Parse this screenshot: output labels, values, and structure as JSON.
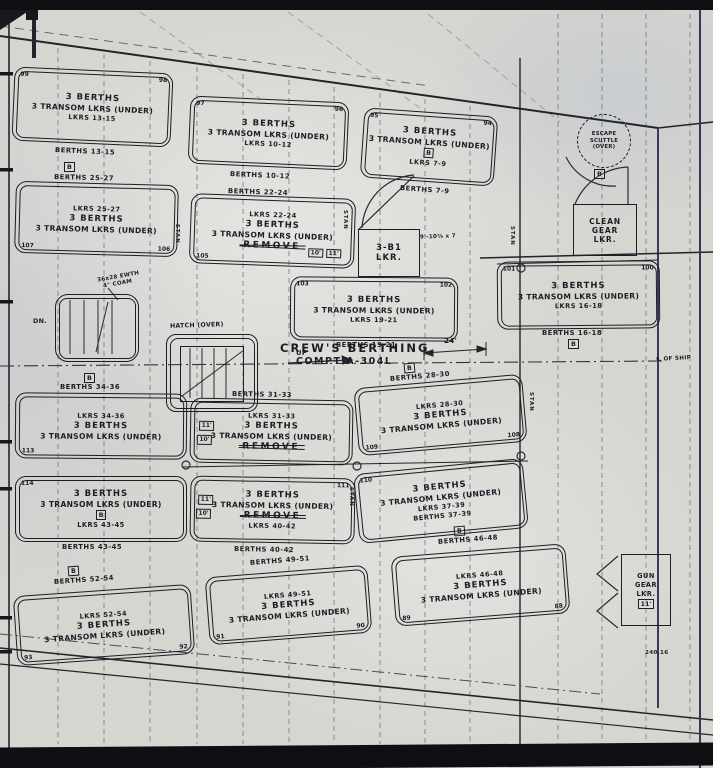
{
  "common": {
    "l1": "3 BERTHS",
    "l2": "3 TRANSOM LKRS (UNDER)",
    "remove": "REMOVE",
    "b": "B"
  },
  "title": {
    "line1": "CREW'S BERTHING",
    "line2": "COMPT A-304L"
  },
  "notes": {
    "up": "UP",
    "dn": "DN.",
    "hatch": "HATCH (OVER)",
    "ewth1": "36x28 EWTH",
    "ewth2": "4\" COAM",
    "dim24": "24'",
    "dim_note": "9'-10⅜ x 7",
    "centerline": "℄ OF SHIP",
    "frame": "240.16",
    "stan": "STAN"
  },
  "lockers": {
    "escape": {
      "l1": "ESCAPE",
      "l2": "SCUTTLE",
      "l3": "(OVER)"
    },
    "clean": {
      "l1": "CLEAN",
      "l2": "GEAR",
      "l3": "LKR."
    },
    "b1": {
      "l1": "3-B1",
      "l2": "LKR."
    },
    "gun": {
      "l1": "GUN",
      "l2": "GEAR",
      "l3": "LKR.",
      "size": "11'"
    }
  },
  "blocks": {
    "r1a": {
      "lkrs": "LKRS 13-15",
      "berths": "BERTHS 13-15",
      "n1": "99",
      "n2": "98"
    },
    "r1b": {
      "lkrs": "LKRS 10-12",
      "berths": "BERTHS 10-12",
      "n1": "97",
      "n2": "96"
    },
    "r1c": {
      "lkrs": "LKRS 7-9",
      "berths": "BERTHS 7-9",
      "n1": "95",
      "n2": "94"
    },
    "r2a": {
      "lkrs": "LKRS 25-27",
      "berths": "BERTHS 25-27",
      "n1": "107",
      "n2": "106"
    },
    "r2b": {
      "lkrs": "LKRS 22-24",
      "berths": "BERTHS 22-24",
      "n1": "105",
      "s1": "10'",
      "s2": "11'"
    },
    "r2c": {
      "lkrs": "LKRS 19-21",
      "berths": "BERTHS 19-21",
      "n1": "103",
      "n2": "102"
    },
    "r2d": {
      "lkrs": "LKRS 16-18",
      "berths": "BERTHS 16-18",
      "n1": "101",
      "n2": "100"
    },
    "r3a": {
      "lkrs": "LKRS 34-36",
      "berths": "BERTHS 34-36",
      "n1": "113"
    },
    "r3b": {
      "lkrs": "LKRS 31-33",
      "berths": "BERTHS 31-33",
      "s1": "11'",
      "s2": "10'"
    },
    "r3c": {
      "lkrs": "LKRS 28-30",
      "berths": "BERTHS 28-30",
      "n1": "109",
      "n2": "108"
    },
    "r4a": {
      "lkrs": "LKRS 43-45",
      "berths": "BERTHS 43-45",
      "n1": "114"
    },
    "r4b": {
      "lkrs": "LKRS 40-42",
      "berths": "BERTHS 40-42",
      "n2": "111",
      "s1": "11'",
      "s2": "10'"
    },
    "r4c": {
      "lkrs": "LKRS 37-39",
      "berths": "BERTHS 37-39",
      "n1": "110"
    },
    "r5a": {
      "lkrs": "LKRS 52-54",
      "berths": "BERTHS 52-54",
      "n1": "93",
      "n2": "92"
    },
    "r5b": {
      "lkrs": "LKRS 49-51",
      "berths": "BERTHS 49-51",
      "n1": "91",
      "n2": "90"
    },
    "r5c": {
      "lkrs": "LKRS 46-48",
      "berths": "BERTHS 46-48",
      "n1": "89",
      "n2": "88"
    }
  }
}
